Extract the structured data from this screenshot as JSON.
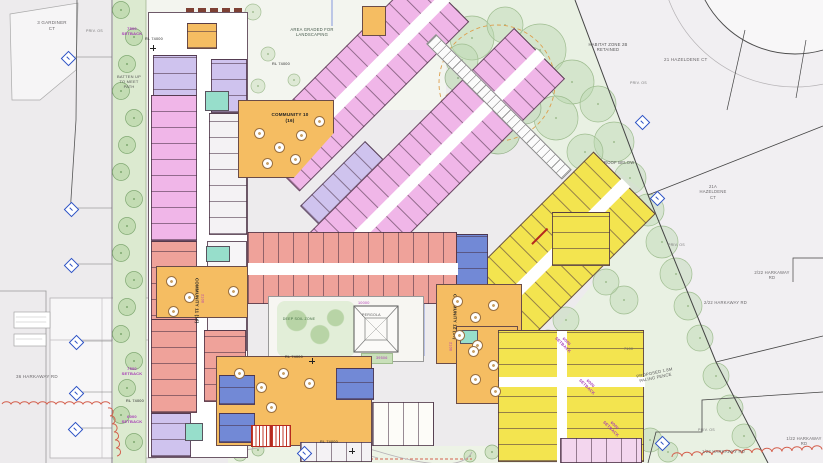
{
  "colors": {
    "room_pink": "#f0b6e8",
    "room_lavender": "#cfc3ee",
    "room_salmon": "#efa29a",
    "room_yellow": "#f3e44f",
    "room_orange": "#f5bd62",
    "room_blue": "#7289d6",
    "room_teal": "#97decb",
    "stair_red": "#b5291e",
    "setback_purple": "#a63ab5",
    "marker_blue": "#2d52c5",
    "vegetation_red": "#d4604e",
    "landscape_green": "#dcead0",
    "neighbor_grey": "#edebed"
  },
  "neighbors": {
    "gardiner": "3 GARDINER CT",
    "harkaway36": "36 HARKAWAY RD",
    "hazeldene21": "21 HAZELDENE CT",
    "hazeldene21a": "21A HAZELDENE CT",
    "harkaway222": "2/22 HARKAWAY RD",
    "harkaway122": "1/22 HARKAWAY RD",
    "priv_os": "PRIV. OS"
  },
  "site": {
    "area_graded": "AREA GRADED FOR LANDSCAPING",
    "batten": "BATTEN UP TO MEET PATH",
    "habitat": "HABITAT ZONE 2B RETAINED",
    "roof_below": "ROOF BELOW",
    "fence": "PROPOSED 1.8M PALING FENCE",
    "deep_soil": "DEEP SOIL ZONE",
    "pergola": "PERGOLA",
    "level": "RL 74000"
  },
  "communities": {
    "c10": "COMMUNITY 10 (16)",
    "c11": "COMMUNITY 11 (16)",
    "c12": "COMMUNITY 12 (16)"
  },
  "setbacks": {
    "s7500": "7500 SETBACK",
    "s6000": "6000 SETBACK"
  },
  "dims": {
    "d2100": "2100",
    "d10000": "10000",
    "d39506": "39506",
    "d7100": "7100"
  }
}
